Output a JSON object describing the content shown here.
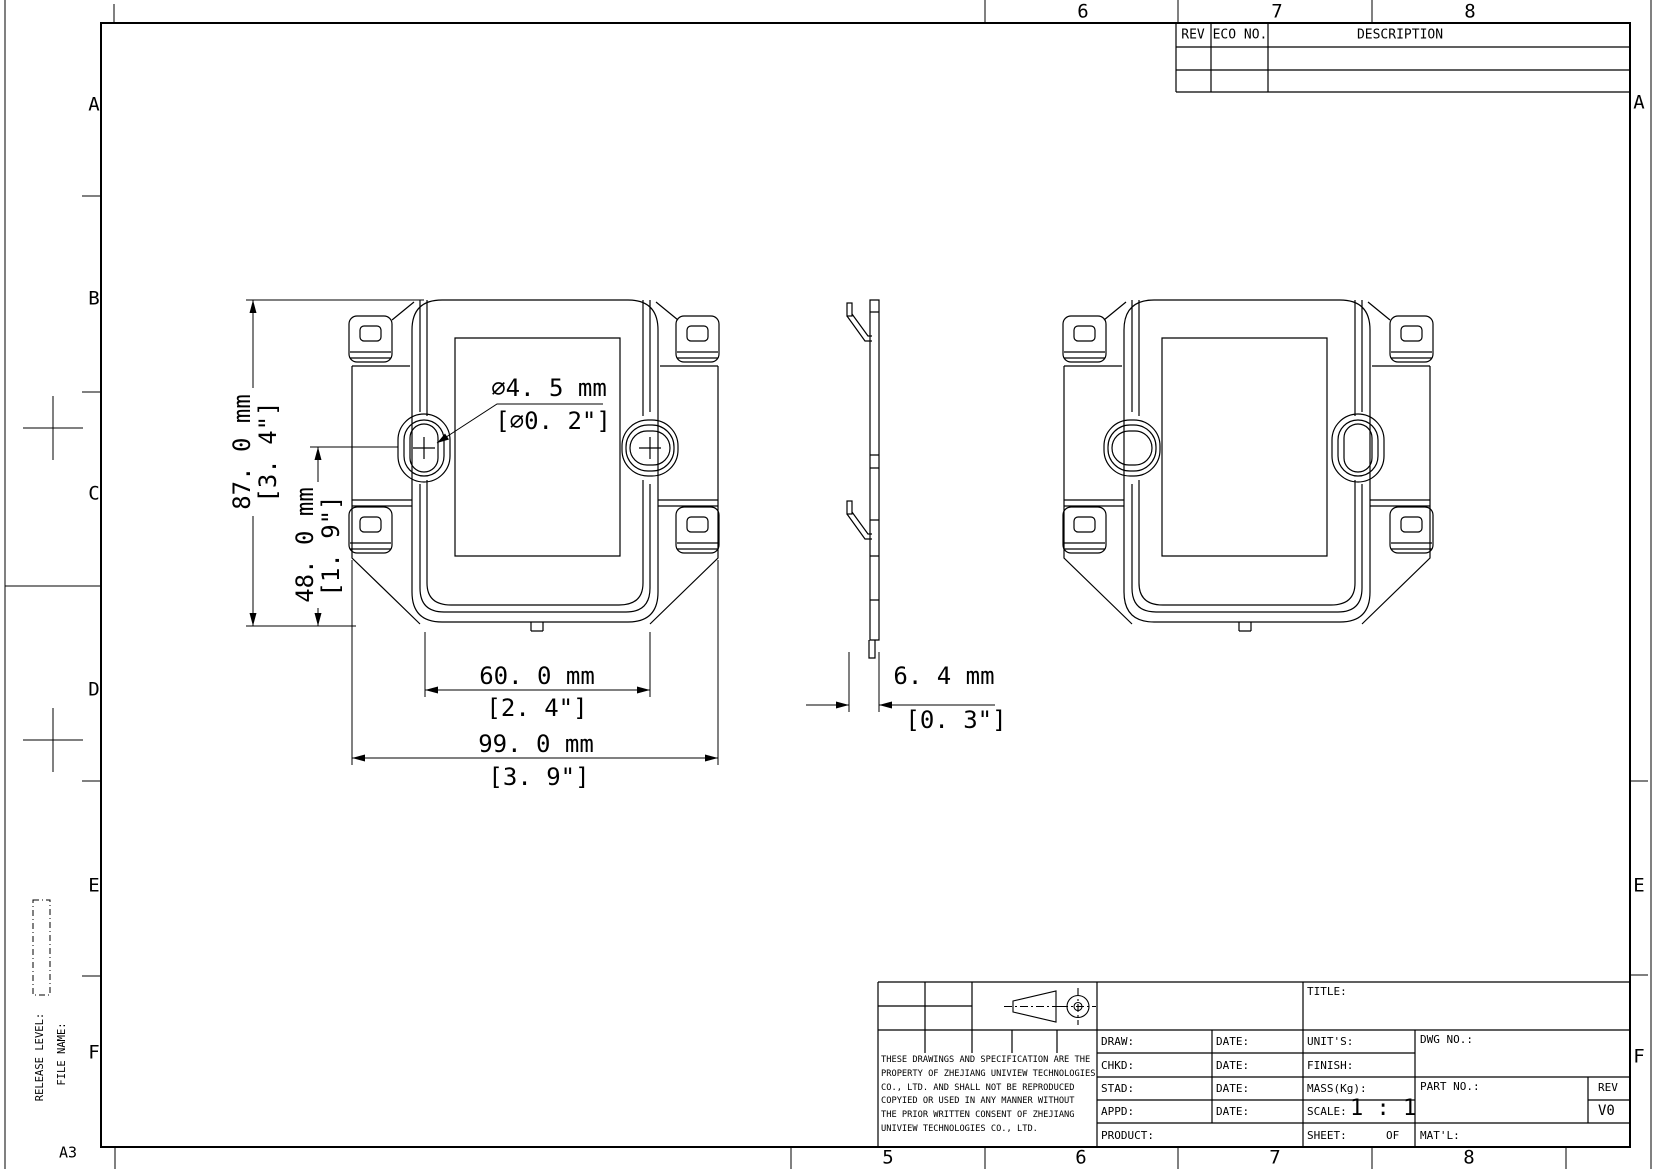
{
  "sheet": {
    "format": "A3",
    "release_level_label": "RELEASE LEVEL:",
    "file_name_label": "FILE NAME:",
    "grid": {
      "top_numbers": [
        "6",
        "7",
        "8"
      ],
      "bottom_numbers": [
        "5",
        "6",
        "7",
        "8"
      ],
      "left_letters": [
        "A",
        "B",
        "C",
        "D",
        "E",
        "F"
      ],
      "right_letters": [
        "A",
        "E",
        "F"
      ]
    }
  },
  "revision_table": {
    "rev_header": "REV",
    "eco_header": "ECO NO.",
    "description_header": "DESCRIPTION"
  },
  "dimensions": {
    "overall_height_mm": "87. 0 mm",
    "overall_height_in": "[3. 4\"]",
    "hole_offset_mm": "48. 0 mm",
    "hole_offset_in": "[1. 9\"]",
    "hole_diameter_mm": "∅4. 5 mm",
    "hole_diameter_in": "[∅0. 2\"]",
    "slot_spacing_mm": "60. 0 mm",
    "slot_spacing_in": "[2. 4\"]",
    "overall_width_mm": "99. 0 mm",
    "overall_width_in": "[3. 9\"]",
    "thickness_mm": "6. 4 mm",
    "thickness_in": "[0. 3\"]"
  },
  "title_block": {
    "title_label": "TITLE:",
    "draw_label": "DRAW:",
    "chkd_label": "CHKD:",
    "stad_label": "STAD:",
    "appd_label": "APPD:",
    "date_label": "DATE:",
    "product_label": "PRODUCT:",
    "units_label": "UNIT'S:",
    "finish_label": "FINISH:",
    "mass_label": "MASS(Kg):",
    "scale_label": "SCALE:",
    "scale_value": "1 : 1",
    "sheet_label": "SHEET:",
    "of_label": "OF",
    "dwg_no_label": "DWG NO.:",
    "part_no_label": "PART NO.:",
    "rev_label": "REV",
    "rev_value": "V0",
    "matl_label": "MAT'L:",
    "notice_lines": [
      "THESE DRAWINGS AND SPECIFICATION ARE THE",
      "PROPERTY OF ZHEJIANG UNIVIEW TECHNOLOGIES",
      "CO., LTD. AND SHALL NOT BE REPRODUCED",
      "COPYIED OR USED IN ANY MANNER WITHOUT",
      "THE PRIOR WRITTEN CONSENT OF ZHEJIANG",
      "UNIVIEW TECHNOLOGIES CO., LTD."
    ]
  }
}
